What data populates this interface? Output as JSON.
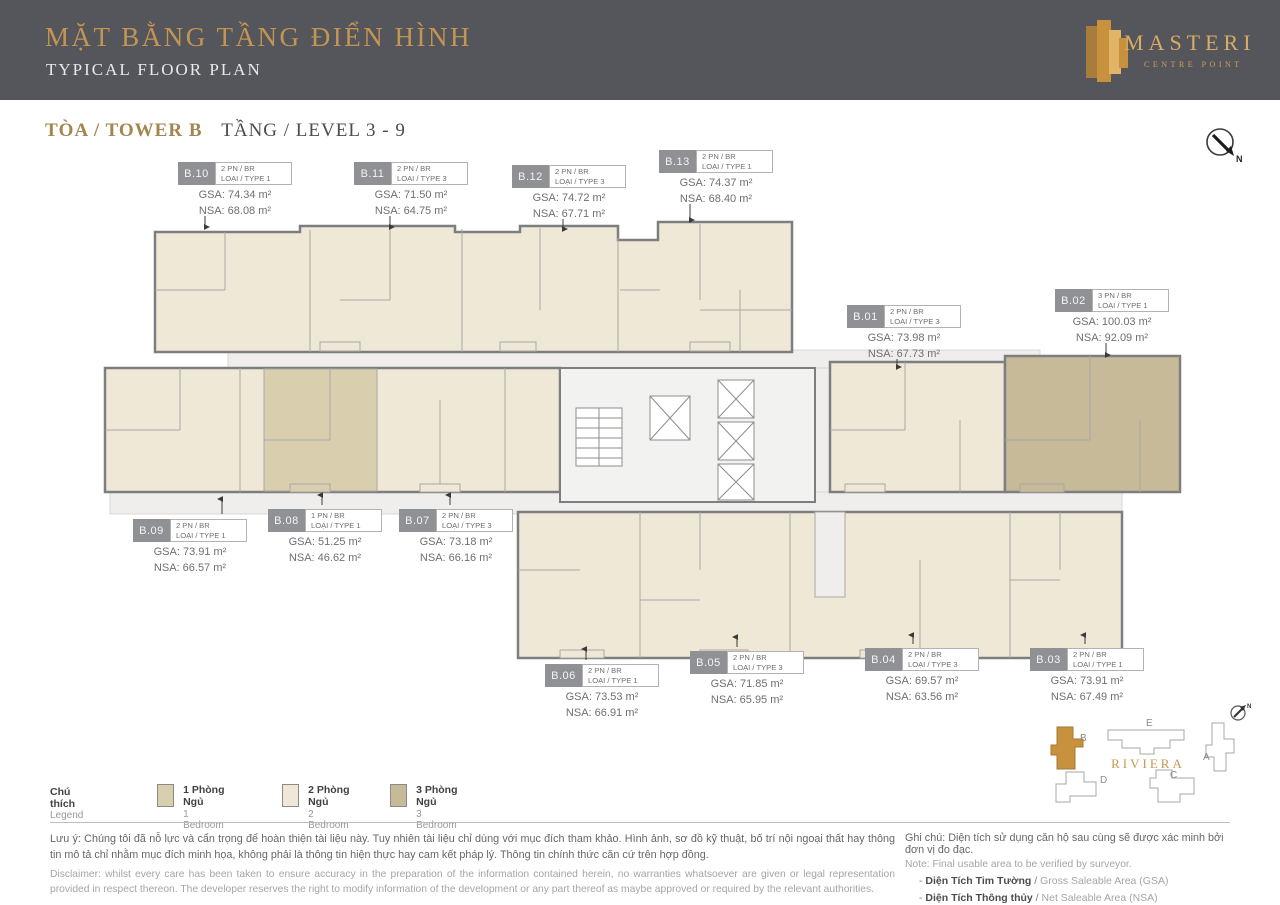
{
  "header": {
    "title_vi": "MẶT BẰNG TẦNG ĐIỂN HÌNH",
    "title_en": "TYPICAL FLOOR PLAN",
    "logo": {
      "name": "MASTERI",
      "sub": "CENTRE POINT"
    }
  },
  "plan_header": {
    "tower_label": "TÒA / TOWER B",
    "level_label": "TẦNG / LEVEL 3 - 9"
  },
  "compass": {
    "label": "N"
  },
  "colors": {
    "accent_gold": "#c49552",
    "header_bg": "#54565b",
    "one_bedroom": "#d9cfae",
    "two_bedroom": "#efe8d7",
    "three_bedroom": "#c6ba99",
    "tower_highlight": "#c8913e"
  },
  "units": [
    {
      "id": "B.01",
      "br": "2 PN / BR",
      "type": "LOẠI / TYPE 3",
      "gsa": "GSA: 73.98 m²",
      "nsa": "NSA: 67.73 m²"
    },
    {
      "id": "B.02",
      "br": "3 PN / BR",
      "type": "LOẠI / TYPE 1",
      "gsa": "GSA: 100.03 m²",
      "nsa": "NSA: 92.09 m²"
    },
    {
      "id": "B.03",
      "br": "2 PN / BR",
      "type": "LOẠI / TYPE 1",
      "gsa": "GSA: 73.91 m²",
      "nsa": "NSA: 67.49 m²"
    },
    {
      "id": "B.04",
      "br": "2 PN / BR",
      "type": "LOẠI / TYPE 3",
      "gsa": "GSA: 69.57 m²",
      "nsa": "NSA: 63.56 m²"
    },
    {
      "id": "B.05",
      "br": "2 PN / BR",
      "type": "LOẠI / TYPE 3",
      "gsa": "GSA: 71.85 m²",
      "nsa": "NSA: 65.95 m²"
    },
    {
      "id": "B.06",
      "br": "2 PN / BR",
      "type": "LOẠI / TYPE 1",
      "gsa": "GSA: 73.53 m²",
      "nsa": "NSA: 66.91 m²"
    },
    {
      "id": "B.07",
      "br": "2 PN / BR",
      "type": "LOẠI / TYPE 3",
      "gsa": "GSA: 73.18 m²",
      "nsa": "NSA: 66.16 m²"
    },
    {
      "id": "B.08",
      "br": "1 PN / BR",
      "type": "LOẠI / TYPE 1",
      "gsa": "GSA: 51.25 m²",
      "nsa": "NSA: 46.62 m²"
    },
    {
      "id": "B.09",
      "br": "2 PN / BR",
      "type": "LOẠI / TYPE 1",
      "gsa": "GSA: 73.91 m²",
      "nsa": "NSA: 66.57 m²"
    },
    {
      "id": "B.10",
      "br": "2 PN / BR",
      "type": "LOẠI / TYPE 1",
      "gsa": "GSA: 74.34 m²",
      "nsa": "NSA: 68.08 m²"
    },
    {
      "id": "B.11",
      "br": "2 PN / BR",
      "type": "LOẠI / TYPE 3",
      "gsa": "GSA: 71.50 m²",
      "nsa": "NSA: 64.75 m²"
    },
    {
      "id": "B.12",
      "br": "2 PN / BR",
      "type": "LOẠI / TYPE 3",
      "gsa": "GSA: 74.72 m²",
      "nsa": "NSA: 67.71 m²"
    },
    {
      "id": "B.13",
      "br": "2 PN / BR",
      "type": "LOẠI / TYPE 1",
      "gsa": "GSA: 74.37 m²",
      "nsa": "NSA: 68.40 m²"
    }
  ],
  "legend": {
    "title_vi": "Chú thích",
    "title_en": "Legend",
    "items": [
      {
        "vi": "1 Phòng Ngủ",
        "en": "1 Bedroom",
        "color": "#d9cfae"
      },
      {
        "vi": "2 Phòng Ngủ",
        "en": "2 Bedroom",
        "color": "#efe8d7"
      },
      {
        "vi": "3 Phòng Ngủ",
        "en": "3 Bedroom",
        "color": "#c6ba99"
      }
    ]
  },
  "disclaimer": {
    "vi": "Lưu ý: Chúng tôi đã nỗ lực và cẩn trọng để hoàn thiện tài liệu này. Tuy nhiên tài liệu chỉ dùng với mục đích tham khảo. Hình ảnh, sơ đồ kỹ thuật, bố trí nội ngoại thất hay thông tin mô tả chỉ nhằm mục đích minh họa, không phải là thông tin hiện thực hay cam kết pháp lý. Thông tin chính thức căn cứ trên hợp đồng.",
    "en": "Disclaimer: whilst every care has been taken to ensure accuracy in the preparation of the information contained herein, no warranties whatsoever are given or legal representation provided in respect thereon. The developer reserves the right to modify information of the development or any part thereof as maybe approved or required by the relevant authorities."
  },
  "note": {
    "vi": "Ghi chú: Diện tích sử dụng căn hộ sau cùng sẽ được xác minh bởi đơn vị đo đạc.",
    "en": "Note: Final usable area to be verified by surveyor.",
    "items": [
      {
        "vi": "Diện Tích Tim Tường",
        "en": "Gross Saleable Area (GSA)"
      },
      {
        "vi": "Diện Tích Thông thủy",
        "en": "Net Saleable Area (NSA)"
      }
    ]
  },
  "site_map": {
    "label": "RIVIERA",
    "towers": [
      "B",
      "E",
      "A",
      "D",
      "C"
    ],
    "highlighted": "B",
    "compass_label": "N"
  }
}
